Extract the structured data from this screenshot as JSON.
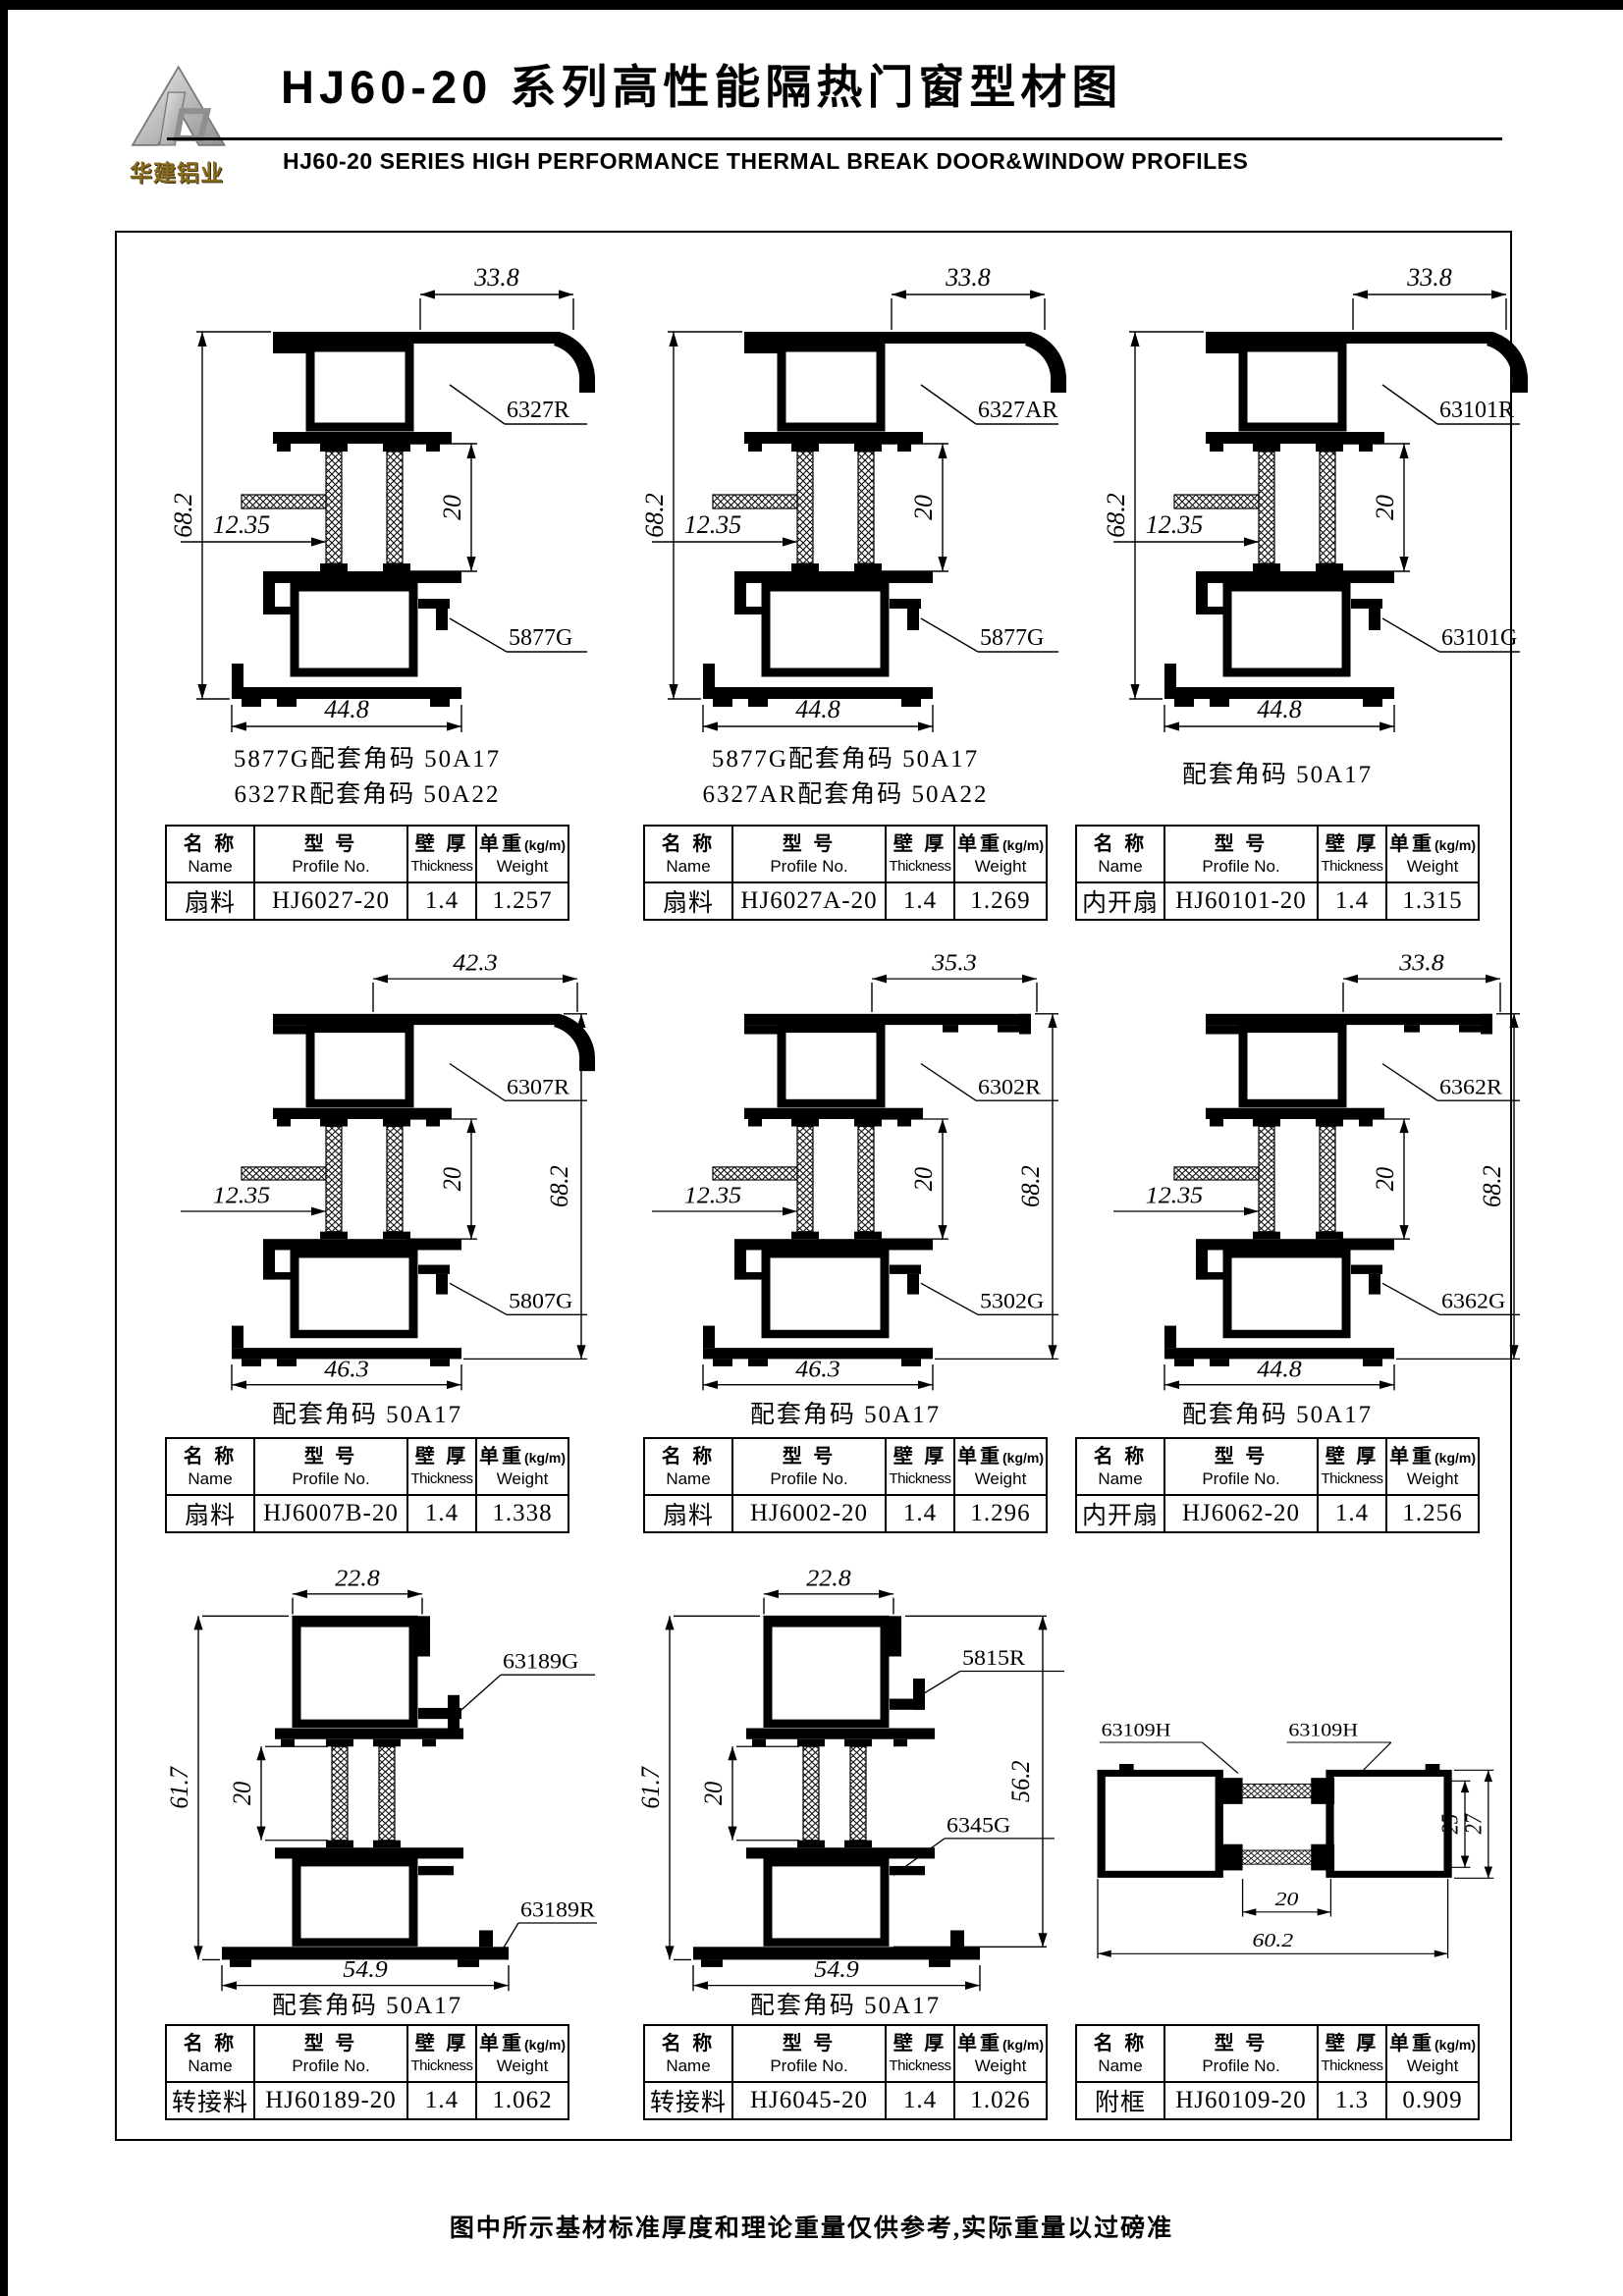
{
  "page": {
    "logo_mark": "HJ",
    "logo_text": "华建铝业",
    "title_cn": "HJ60-20 系列高性能隔热门窗型材图",
    "title_en": "HJ60-20 SERIES HIGH PERFORMANCE THERMAL BREAK DOOR&WINDOW PROFILES",
    "footer_note": "图中所示基材标准厚度和理论重量仅供参考,实际重量以过磅准"
  },
  "table_headers": {
    "name_cn": "名 称",
    "name_en": "Name",
    "profile_cn": "型 号",
    "profile_en": "Profile No.",
    "thickness_cn": "壁 厚",
    "thickness_en": "Thickness",
    "weight_cn": "单重",
    "weight_unit": "(kg/m)",
    "weight_en": "Weight"
  },
  "cells": [
    {
      "dims": {
        "top": "33.8",
        "height": "68.2",
        "offset": "12.35",
        "gap": "20",
        "bottom": "44.8"
      },
      "labels": {
        "upper": "6327R",
        "lower": "5877G"
      },
      "notes": [
        "5877G配套角码 50A17",
        "6327R配套角码 50A22"
      ],
      "row": {
        "name": "扇料",
        "profile": "HJ6027-20",
        "thickness": "1.4",
        "weight": "1.257"
      }
    },
    {
      "dims": {
        "top": "33.8",
        "height": "68.2",
        "offset": "12.35",
        "gap": "20",
        "bottom": "44.8"
      },
      "labels": {
        "upper": "6327AR",
        "lower": "5877G"
      },
      "notes": [
        "5877G配套角码 50A17",
        "6327AR配套角码 50A22"
      ],
      "row": {
        "name": "扇料",
        "profile": "HJ6027A-20",
        "thickness": "1.4",
        "weight": "1.269"
      }
    },
    {
      "dims": {
        "top": "33.8",
        "height": "68.2",
        "offset": "12.35",
        "gap": "20",
        "bottom": "44.8"
      },
      "labels": {
        "upper": "63101R",
        "lower": "63101G"
      },
      "notes": [
        "配套角码 50A17"
      ],
      "row": {
        "name": "内开扇",
        "profile": "HJ60101-20",
        "thickness": "1.4",
        "weight": "1.315"
      }
    },
    {
      "dims": {
        "top": "42.3",
        "height": "68.2",
        "offset": "12.35",
        "gap": "20",
        "bottom": "46.3"
      },
      "labels": {
        "upper": "6307R",
        "lower": "5807G"
      },
      "notes": [
        "配套角码 50A17"
      ],
      "row": {
        "name": "扇料",
        "profile": "HJ6007B-20",
        "thickness": "1.4",
        "weight": "1.338"
      }
    },
    {
      "dims": {
        "top": "35.3",
        "height": "68.2",
        "offset": "12.35",
        "gap": "20",
        "bottom": "46.3"
      },
      "labels": {
        "upper": "6302R",
        "lower": "5302G"
      },
      "notes": [
        "配套角码 50A17"
      ],
      "row": {
        "name": "扇料",
        "profile": "HJ6002-20",
        "thickness": "1.4",
        "weight": "1.296"
      }
    },
    {
      "dims": {
        "top": "33.8",
        "height": "68.2",
        "offset": "12.35",
        "gap": "20",
        "bottom": "44.8"
      },
      "labels": {
        "upper": "6362R",
        "lower": "6362G"
      },
      "notes": [
        "配套角码 50A17"
      ],
      "row": {
        "name": "内开扇",
        "profile": "HJ6062-20",
        "thickness": "1.4",
        "weight": "1.256"
      }
    },
    {
      "dims": {
        "top": "22.8",
        "height": "61.7",
        "gap": "20",
        "bottom": "54.9"
      },
      "labels": {
        "upper": "63189G",
        "lower": "63189R"
      },
      "notes": [
        "配套角码 50A17"
      ],
      "row": {
        "name": "转接料",
        "profile": "HJ60189-20",
        "thickness": "1.4",
        "weight": "1.062"
      }
    },
    {
      "dims": {
        "top": "22.8",
        "height": "61.7",
        "gap": "20",
        "right": "56.2",
        "bottom": "54.9"
      },
      "labels": {
        "upper": "5815R",
        "lower": "6345G"
      },
      "notes": [
        "配套角码 50A17"
      ],
      "row": {
        "name": "转接料",
        "profile": "HJ6045-20",
        "thickness": "1.4",
        "weight": "1.026"
      }
    },
    {
      "dims": {
        "inner": "25",
        "outer": "27",
        "gap": "20",
        "bottom": "60.2"
      },
      "labels": {
        "left": "63109H",
        "right": "63109H"
      },
      "notes": [],
      "row": {
        "name": "附框",
        "profile": "HJ60109-20",
        "thickness": "1.3",
        "weight": "0.909"
      }
    }
  ]
}
